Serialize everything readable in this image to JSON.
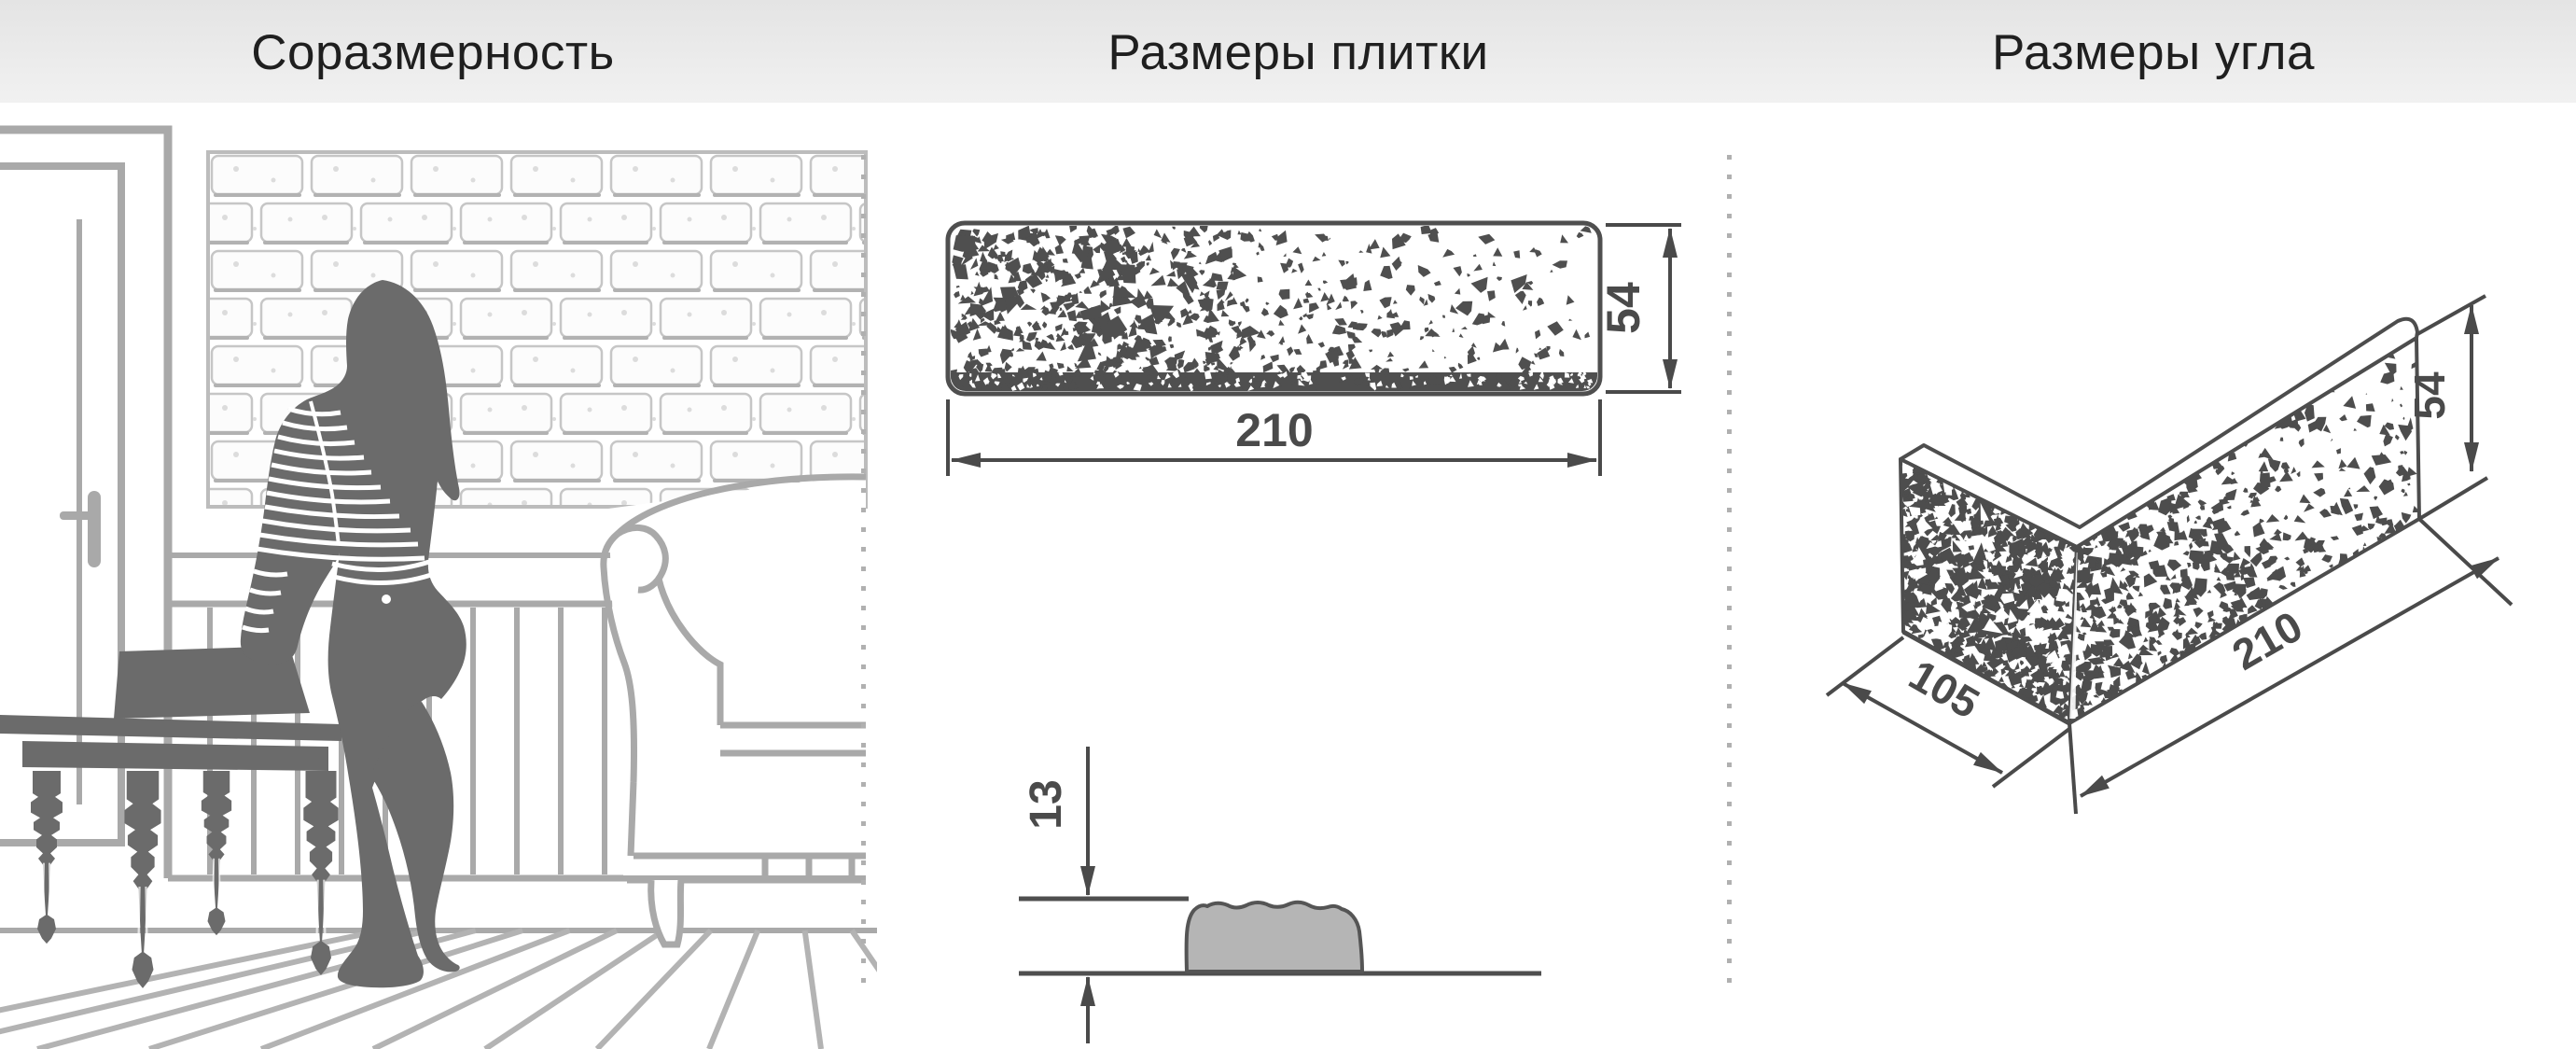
{
  "header": {
    "sections": [
      {
        "title": "Соразмерность"
      },
      {
        "title": "Размеры плитки"
      },
      {
        "title": "Размеры угла"
      }
    ]
  },
  "tile": {
    "width_label": "210",
    "height_label": "54",
    "thickness_label": "13"
  },
  "corner": {
    "depth_label": "105",
    "length_label": "210",
    "height_label": "54"
  },
  "colors": {
    "dimension": "#4a4a4a",
    "scene_outline": "#a9a9a9",
    "silhouette": "#6b6b6b",
    "profile_fill": "#b5b5b5",
    "dots": "#b0b0b0",
    "header_text": "#1f1f1f"
  }
}
